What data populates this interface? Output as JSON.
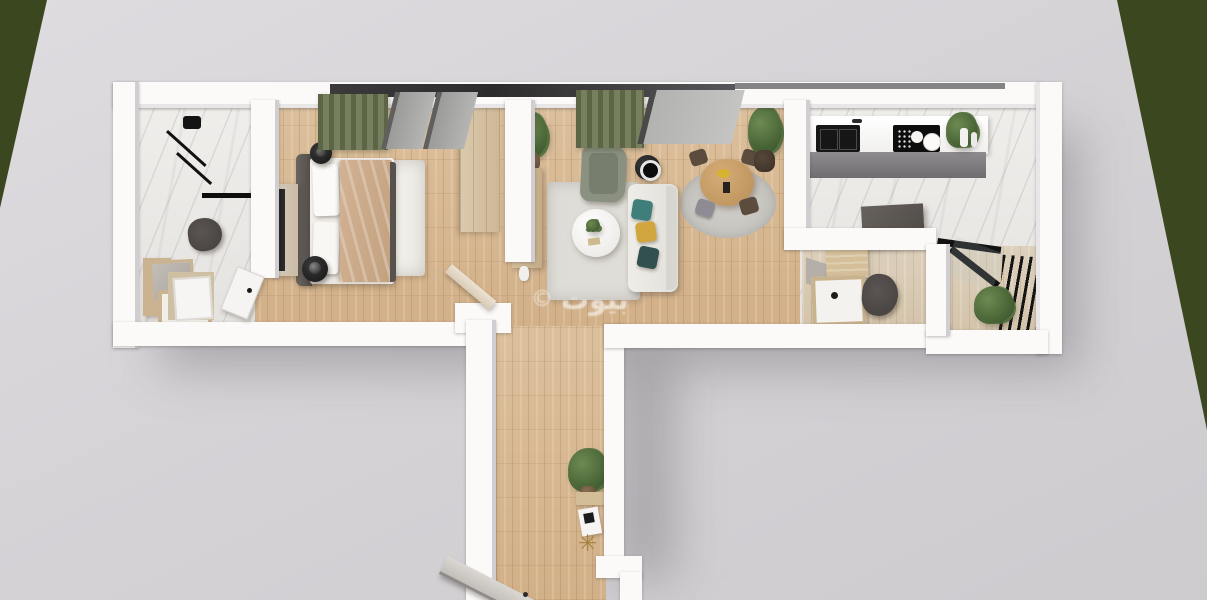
{
  "scene": {
    "type": "3d-apartment-floor-plan-render-top-down",
    "watermark": {
      "copyright_symbol": "©",
      "text": "بيوت"
    },
    "decor": {
      "star_glyph": "✳"
    },
    "environment": {
      "ground_color": "#d6d4d7",
      "grass_color": "#3a471f",
      "wall_color": "#fbfaf9"
    },
    "palette": {
      "wood_floor": "#d7b891",
      "marble_floor": "#edebe8",
      "curtain_green": "#6b7354",
      "sofa_white": "#ebe9e4",
      "armchair_gray_green": "#8b9180",
      "pillow_teal": "#3f7e7b",
      "pillow_yellow": "#d2a63e",
      "dining_table_wood": "#c79a66",
      "blanket_tan": "#c9ad8c",
      "fixture_black": "#1b1b1b",
      "toilet_dark": "#4b4643",
      "vanity_wood": "#cbb391",
      "rug_bedroom": "#f0eee9",
      "rug_living": "#dfddd7",
      "rug_dining": "#c9c7c2",
      "plant_green": "#4a6637",
      "island_gray": "#5c5754",
      "door_panel_gray": "#d8d4d0"
    },
    "rooms": [
      {
        "id": "bathroom-1",
        "floor": "marble",
        "items": [
          "shower-fixture",
          "shower-glass-bar",
          "toilet",
          "vanity-with-mirror",
          "entry-door",
          "bathroom-door"
        ]
      },
      {
        "id": "bedroom",
        "floor": "wood",
        "items": [
          "double-bed",
          "headboard",
          "blanket",
          "pillows",
          "nightstand-left",
          "nightstand-right",
          "area-rug",
          "tv-dresser",
          "wardrobe",
          "green-curtain",
          "window-panels",
          "swing-door"
        ]
      },
      {
        "id": "living-room",
        "floor": "wood",
        "items": [
          "white-sofa",
          "throw-pillows",
          "gray-armchair",
          "round-coffee-table",
          "black-side-table",
          "tv-console",
          "area-rug",
          "potted-plant",
          "green-curtain",
          "window-panel"
        ]
      },
      {
        "id": "dining-area",
        "floor": "wood",
        "items": [
          "round-wood-table",
          "four-chairs",
          "round-rug",
          "potted-plant",
          "table-decor"
        ]
      },
      {
        "id": "kitchen",
        "floor": "marble",
        "items": [
          "counter",
          "double-sink",
          "cooktop",
          "plates",
          "counter-plant",
          "cabinet-front",
          "dark-island"
        ]
      },
      {
        "id": "bathroom-2",
        "floor": "wood",
        "items": [
          "vanity-sink",
          "mirror",
          "shelf",
          "toilet"
        ]
      },
      {
        "id": "balcony",
        "floor": "wood",
        "items": [
          "black-railing",
          "glass-partition",
          "potted-plant"
        ]
      },
      {
        "id": "hallway",
        "floor": "wood",
        "items": [
          "potted-plant",
          "wood-shelf",
          "magazine",
          "star-decor",
          "open-door"
        ]
      }
    ]
  }
}
